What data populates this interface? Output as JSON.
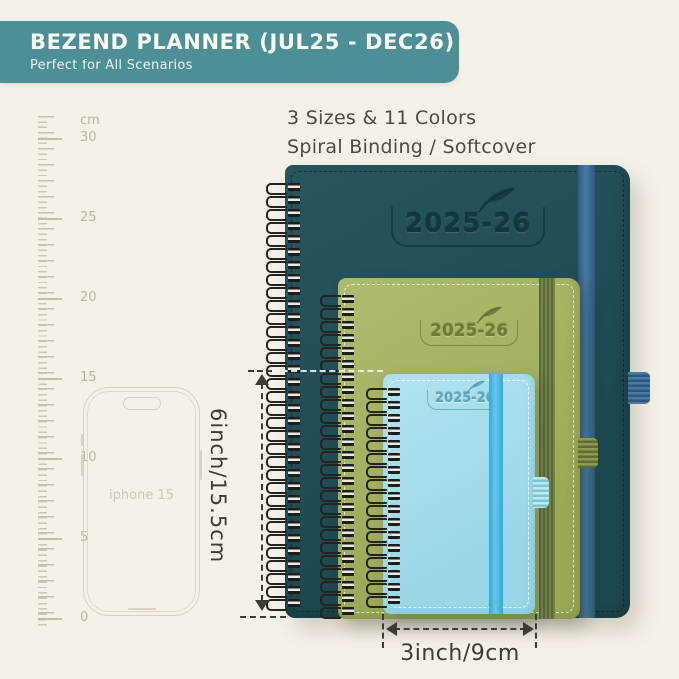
{
  "header": {
    "title": "BEZEND PLANNER (JUL25 - DEC26)",
    "subtitle": "Perfect for All Scenarios",
    "bg_color": "#4c8f96"
  },
  "intro": {
    "line1": "3 Sizes & 11 Colors",
    "line2": "Spiral Binding / Softcover"
  },
  "ruler": {
    "unit": "cm",
    "labels": [
      "30",
      "25",
      "20",
      "15",
      "10",
      "5",
      "0"
    ]
  },
  "phone": {
    "label": "iphone 15"
  },
  "planners": {
    "large": {
      "year": "2025-26",
      "cover_color": "#22525b",
      "band_color": "#3c6c95"
    },
    "medium": {
      "year": "2025-26",
      "cover_color": "#a5b363",
      "band_color": "#66743c"
    },
    "small": {
      "year": "2025-26",
      "cover_color": "#a6dcea",
      "band_color": "#45b5e4"
    }
  },
  "dimensions": {
    "height_label": "6inch/15.5cm",
    "width_label": "3inch/9cm"
  }
}
